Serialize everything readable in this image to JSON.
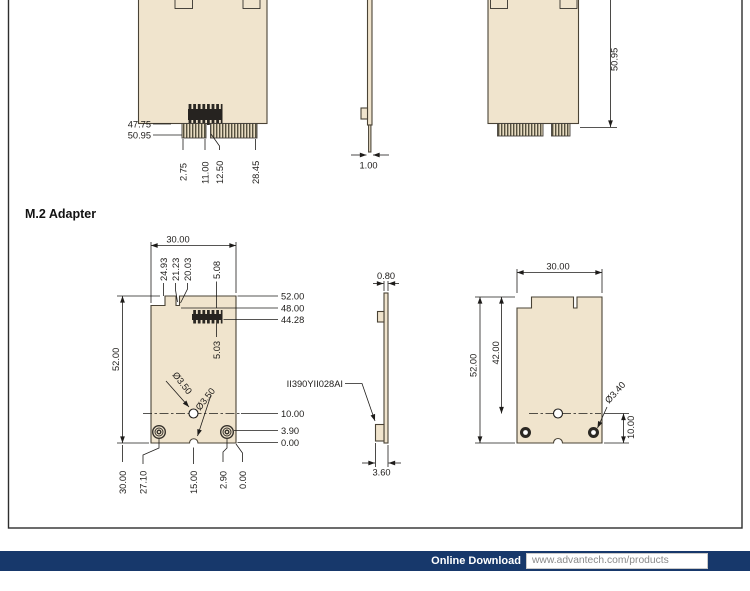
{
  "mini_pcie": {
    "front": {
      "l1": "47.75",
      "l2": "50.95",
      "b1": "2.75",
      "b2": "11.00",
      "b3": "12.50",
      "b4": "28.45"
    },
    "side": {
      "w": "1.00"
    },
    "back": {
      "h": "50.95"
    }
  },
  "m2": {
    "heading": "M.2 Adapter",
    "front": {
      "w": "30.00",
      "t1": "24.93",
      "t2": "21.23",
      "t3": "20.03",
      "t4": "5.08",
      "r1": "52.00",
      "r2": "48.00",
      "r3": "44.28",
      "h": "52.00",
      "pin": "5.03",
      "d1": "Ø3.50",
      "d2": "Ø3.50",
      "r4": "10.00",
      "r5": "3.90",
      "r6": "0.00",
      "b1": "30.00",
      "b2": "27.10",
      "b3": "15.00",
      "b4": "2.90",
      "b5": "0.00"
    },
    "side": {
      "t": "0.80",
      "part": "II390YII028AI",
      "b": "3.60"
    },
    "back": {
      "w": "30.00",
      "h": "52.00",
      "inner": "42.00",
      "dia": "Ø3.40",
      "off": "10.00"
    }
  },
  "footer": {
    "label": "Online Download",
    "url": "www.advantech.com/products"
  },
  "colors": {
    "board": "#f0e4cd",
    "line": "#1e1c1a",
    "navy": "#17386b"
  }
}
